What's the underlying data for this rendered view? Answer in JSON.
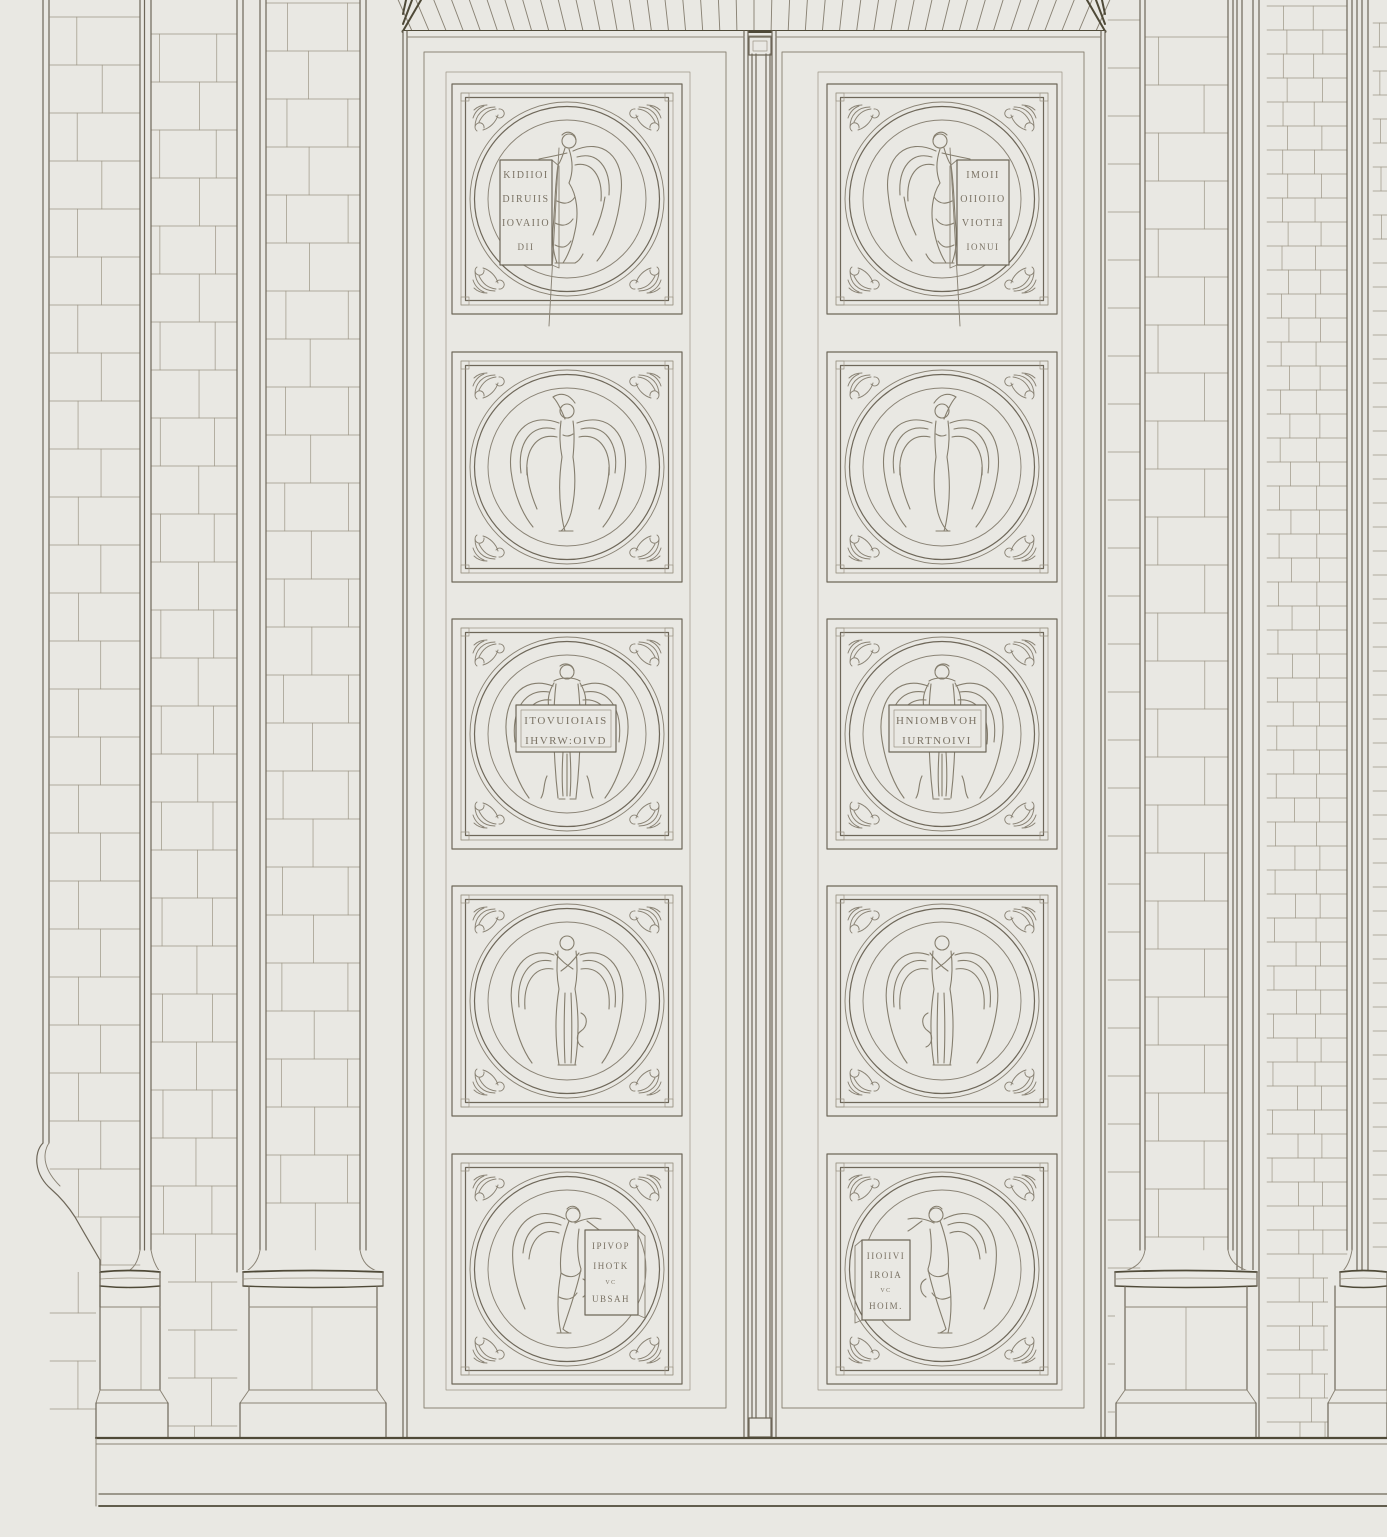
{
  "plate": {
    "kind": "architectural-elevation-engraving",
    "subject": "double-door-with-angel-medallion-panels"
  },
  "colors": {
    "paper": "#e9e8e3",
    "ink_light": "#9c9585",
    "ink_medium": "#8a8375",
    "ink_dark": "#6e6759",
    "ink_heavy": "#4f4a38",
    "inscription": "#7a7264"
  },
  "door": {
    "leaf_count": 2,
    "panels_per_leaf": 5,
    "panels": [
      {
        "id": "r1-left",
        "pose": "angel-leaning-on-stele-left",
        "tablet_lines": [
          "KIDIIOI",
          "DIRUIIS",
          "IOVAIIO",
          "DII"
        ]
      },
      {
        "id": "r1-right",
        "pose": "angel-leaning-on-stele-right",
        "tablet_lines": [
          "IMOII",
          "OIIOIIO",
          "VIOTIƎ",
          "IONUI"
        ]
      },
      {
        "id": "r2-left",
        "pose": "angel-arm-raised",
        "tablet_lines": []
      },
      {
        "id": "r2-right",
        "pose": "angel-praying",
        "tablet_lines": []
      },
      {
        "id": "r3-left",
        "pose": "angel-holding-tablet",
        "tablet_lines": [
          "ITOVUIOIAIS",
          "IHVRW:OIVD"
        ]
      },
      {
        "id": "r3-right",
        "pose": "angel-holding-tablet",
        "tablet_lines": [
          "HNIOMBVOH",
          "IURTNOIVI"
        ]
      },
      {
        "id": "r4-left",
        "pose": "angel-hands-clasped",
        "tablet_lines": []
      },
      {
        "id": "r4-right",
        "pose": "angel-hands-clasped",
        "tablet_lines": []
      },
      {
        "id": "r5-left",
        "pose": "angel-leaning-on-pedestal-right",
        "tablet_lines": [
          "IPIVOP",
          "IHOTK",
          "VC",
          "UBSAH"
        ]
      },
      {
        "id": "r5-right",
        "pose": "angel-leaning-on-pedestal-left",
        "tablet_lines": [
          "IIOIIVI",
          "IROIA",
          "VC",
          "HOIM."
        ]
      }
    ]
  }
}
